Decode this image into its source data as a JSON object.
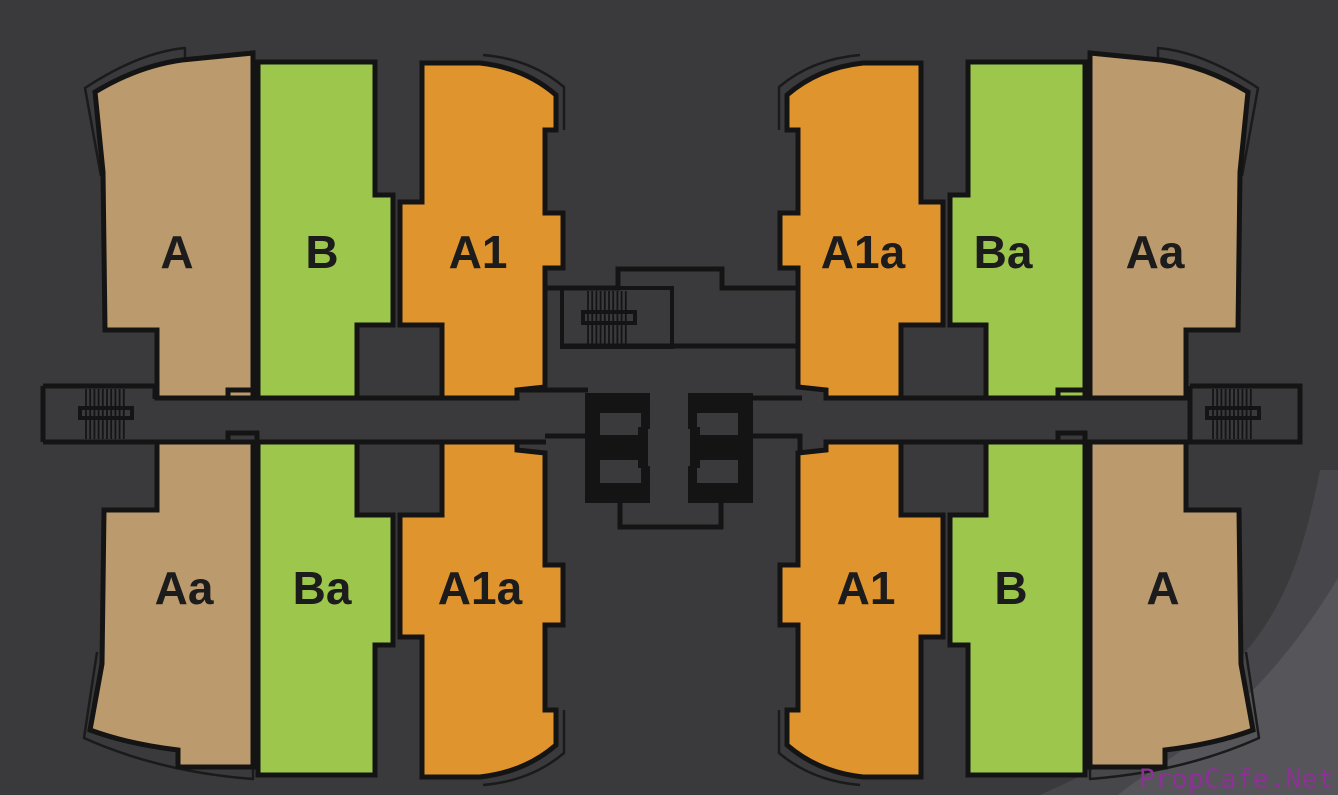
{
  "page": {
    "type": "apartment-floor-plan-slide"
  },
  "palette": {
    "background": "#3a3a3c",
    "swoosh_mid": "#47474b",
    "swoosh_light": "#55555a",
    "wall_line": "#141414",
    "label": "#1c1c1c",
    "unit_tan": "#BB9A6E",
    "unit_green": "#9DC74C",
    "unit_orange": "#E0942E"
  },
  "units": [
    {
      "label": "A",
      "type": "tan",
      "position": "top-left-outer"
    },
    {
      "label": "B",
      "type": "green",
      "position": "top-left-middle"
    },
    {
      "label": "A1",
      "type": "orange",
      "position": "top-left-inner"
    },
    {
      "label": "A1a",
      "type": "orange",
      "position": "top-right-inner"
    },
    {
      "label": "Ba",
      "type": "green",
      "position": "top-right-middle"
    },
    {
      "label": "Aa",
      "type": "tan",
      "position": "top-right-outer"
    },
    {
      "label": "Aa",
      "type": "tan",
      "position": "bottom-left-outer"
    },
    {
      "label": "Ba",
      "type": "green",
      "position": "bottom-left-middle"
    },
    {
      "label": "A1a",
      "type": "orange",
      "position": "bottom-left-inner"
    },
    {
      "label": "A1",
      "type": "orange",
      "position": "bottom-right-inner"
    },
    {
      "label": "B",
      "type": "green",
      "position": "bottom-right-middle"
    },
    {
      "label": "A",
      "type": "tan",
      "position": "bottom-right-outer"
    }
  ],
  "core": {
    "stairwells": [
      "left-wing",
      "top-center",
      "right-wing"
    ],
    "elevator_banks": [
      "left",
      "right"
    ]
  },
  "watermark": {
    "text": "PropCafe.Net",
    "color": "#8E3096"
  }
}
